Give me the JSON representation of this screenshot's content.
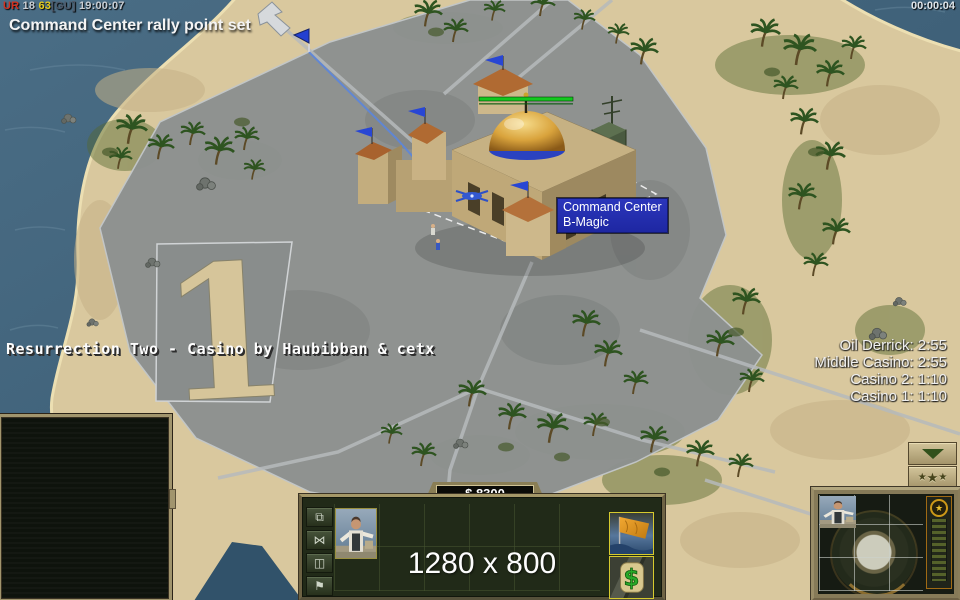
{
  "colors": {
    "tooltip_bg": "#2230b0",
    "health_bar": "#12c81e",
    "gold_frame": "#8a7e55",
    "water": "#3f617a",
    "sand": "#d9c89e",
    "pavement": "#8d9190",
    "slot_highlight": "#d6ca2e"
  },
  "top_bar": {
    "perf_label": "UR",
    "perf_value": " 18 ",
    "fps": "63",
    "tag": "[GU]",
    "session_clock": " 19:00:07",
    "game_timer": "00:00:04"
  },
  "event_message": "Command Center rally point set",
  "map_title": "Resurrection Two - Casino by Haubibban & cetx",
  "pad_number": "1",
  "countdowns": [
    "Oil Derrick: 2:55",
    "Middle Casino: 2:55",
    "Casino 2: 1:10",
    "Casino 1: 1:10"
  ],
  "tooltip": {
    "building": "Command Center",
    "player": "B-Magic"
  },
  "control_bar": {
    "money": "$ 8300",
    "resolution": "1280 x 800"
  },
  "icons": {
    "layers": "⧉",
    "bowtie": "⋈",
    "divider": "◫",
    "flag": "⚑",
    "rank_star": "★",
    "medal_star": "★",
    "dollar": "$",
    "collapse_arrow": "▼"
  }
}
